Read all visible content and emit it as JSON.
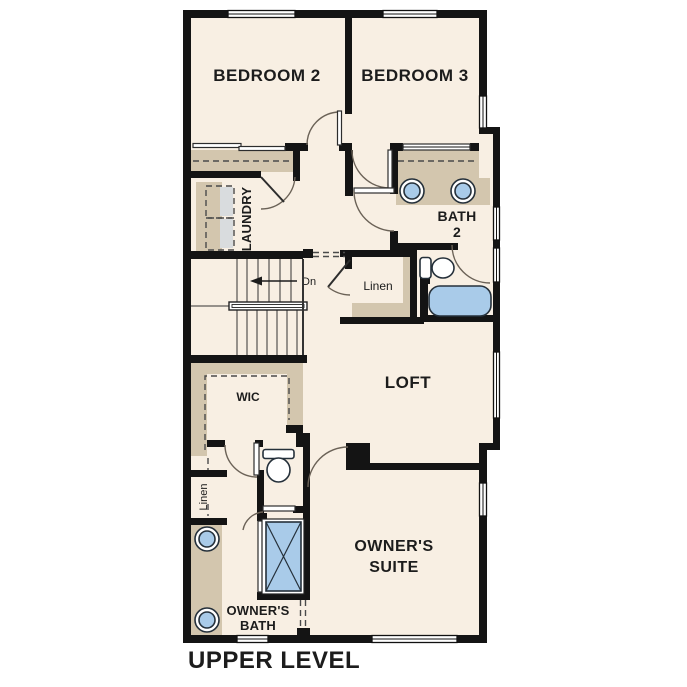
{
  "title": "UPPER LEVEL",
  "colors": {
    "wall": "#141414",
    "floor": "#f8efe3",
    "closet_tan": "#d3c6ae",
    "appliance_gray": "#d9dcde",
    "fixture_blue": "#a9cbe9",
    "fixture_white": "#ffffff",
    "door_arc": "#6b6257",
    "text": "#1c1c1c"
  },
  "rooms": {
    "bedroom2": {
      "label": "BEDROOM 2"
    },
    "bedroom3": {
      "label": "BEDROOM 3"
    },
    "laundry": {
      "label": "LAUNDRY"
    },
    "bath2": {
      "line1": "BATH",
      "line2": "2"
    },
    "hall_linen": {
      "label": "Linen"
    },
    "loft": {
      "label": "LOFT"
    },
    "wic": {
      "label": "WIC"
    },
    "owners_linen": {
      "label": "Linen"
    },
    "owners_suite": {
      "line1": "OWNER'S",
      "line2": "SUITE"
    },
    "owners_bath": {
      "line1": "OWNER'S",
      "line2": "BATH"
    }
  },
  "stairs": {
    "down_label": "Dn"
  },
  "fixtures": [
    "washer-dryer",
    "bath2-double-vanity-sinks",
    "bath2-toilet",
    "bathtub",
    "owners-vanity-sinks",
    "owners-toilet",
    "shower",
    "stair-handrail"
  ]
}
